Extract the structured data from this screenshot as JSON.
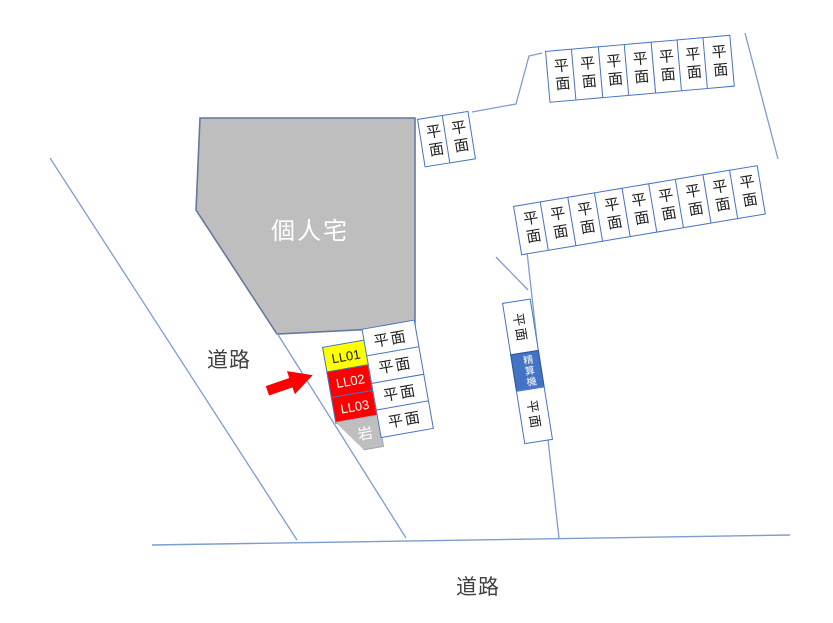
{
  "labels": {
    "private_house": "個人宅",
    "road_left": "道路",
    "road_bottom": "道路",
    "rock": "岩",
    "payment_machine": "精算機",
    "flat_space": "平面"
  },
  "highlighted_spaces": [
    {
      "id": "LL01",
      "fill": "#FFFF00",
      "text_color": "#1A1A1A"
    },
    {
      "id": "LL02",
      "fill": "#FF0000",
      "text_color": "#FFFFFF"
    },
    {
      "id": "LL03",
      "fill": "#FF0000",
      "text_color": "#FFFFFF"
    }
  ],
  "rows": {
    "top_row": {
      "count": 7
    },
    "middle_row": {
      "count": 9
    },
    "upper_pair": {
      "count": 2
    },
    "center_column": {
      "count": 4
    },
    "machine_strip_flat": {
      "count": 2
    }
  },
  "colors": {
    "lot_line": "#7E9CD0",
    "box_border": "#4472C4",
    "house_fill": "#BEBEBE",
    "house_border": "#64799E",
    "machine_fill": "#4472C4",
    "arrow_red": "#FF0000"
  }
}
